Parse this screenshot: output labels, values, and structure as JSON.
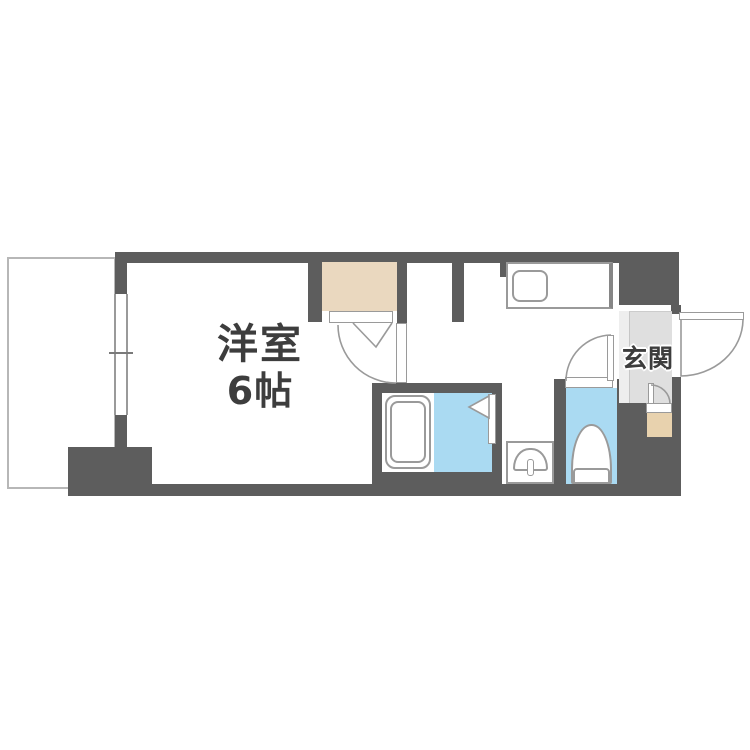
{
  "labels": {
    "main_room_name": "洋室",
    "main_room_size": "6帖",
    "entrance": "玄関"
  },
  "legend": {
    "wall_color": "#5d5d5d",
    "fixture_line_color": "#9a9a9a",
    "water_area_color": "#aadaf2",
    "closet_color": "#ead8bf",
    "shoe_cabinet_color": "#e8d2ae",
    "entrance_floor_color": "#dfdfdf",
    "text_color": "#3d3d3d"
  }
}
